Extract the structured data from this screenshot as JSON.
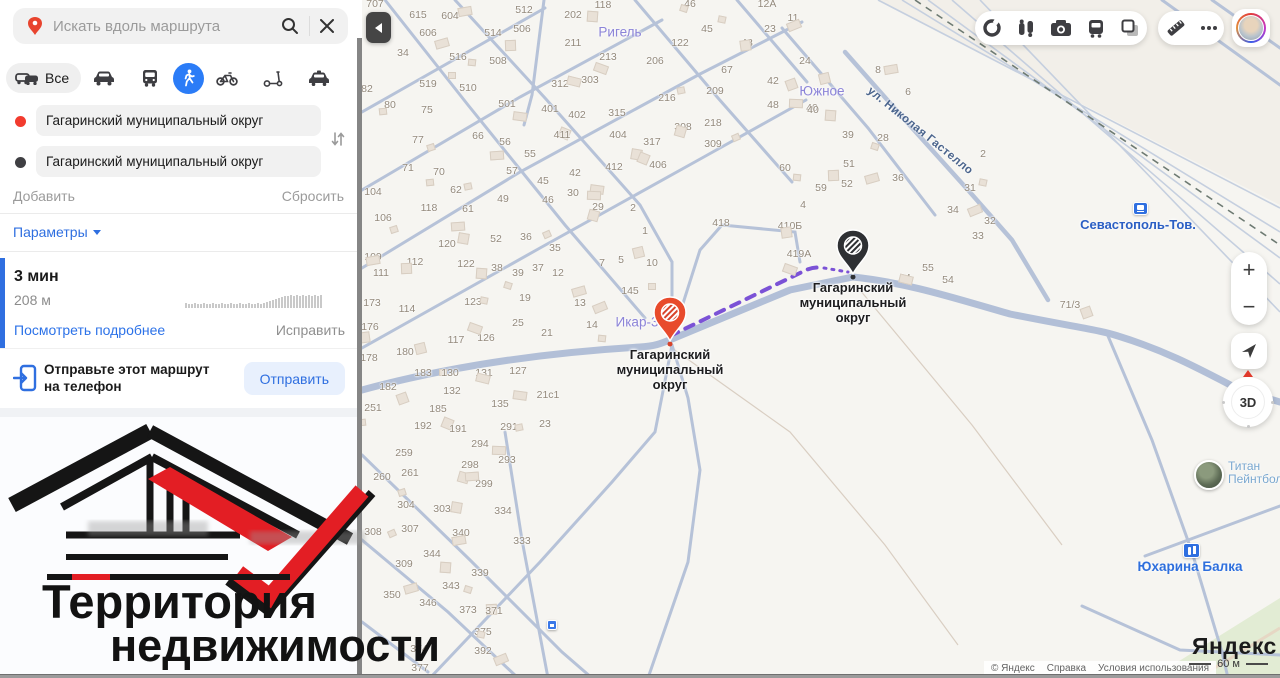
{
  "panel": {
    "search": {
      "placeholder": "Искать вдоль маршрута"
    },
    "modes": {
      "all_label": "Все"
    },
    "route_points": [
      {
        "value": "Гагаринский муниципальный округ"
      },
      {
        "value": "Гагаринский муниципальный округ"
      }
    ],
    "add_label": "Добавить",
    "reset_label": "Сбросить",
    "params_label": "Параметры",
    "summary": {
      "duration": "3 мин",
      "distance": "208 м",
      "details_label": "Посмотреть подробнее",
      "fix_label": "Исправить"
    },
    "send": {
      "line1": "Отправьте этот маршрут",
      "line2": "на телефон",
      "button": "Отправить"
    },
    "logo": {
      "line1": "Территория",
      "line2": "недвижимости"
    }
  },
  "map": {
    "controls": {
      "zoom_in": "+",
      "zoom_out": "−",
      "threed": "3D"
    },
    "markers": [
      {
        "type": "start",
        "x": 670,
        "y": 341,
        "color": "#e84b2c",
        "label_lines": [
          "Гагаринский",
          "муниципальный",
          "округ"
        ]
      },
      {
        "type": "end",
        "x": 853,
        "y": 274,
        "color": "#2e3033",
        "label_lines": [
          "Гагаринский",
          "муниципальный",
          "округ"
        ]
      }
    ],
    "locality_labels": [
      {
        "t": "Ригель",
        "x": 620,
        "y": 32
      },
      {
        "t": "Южное",
        "x": 822,
        "y": 91
      },
      {
        "t": "Икар-3",
        "x": 637,
        "y": 322
      }
    ],
    "street_label": {
      "t": "ул. Николая Гастелло",
      "x": 920,
      "y": 131
    },
    "station": {
      "t": "Севастополь-Тов.",
      "x": 1138,
      "y": 217,
      "icon_x": 1133,
      "icon_y": 202
    },
    "poi": [
      {
        "t1": "Титан",
        "t2": "Пейнтбол",
        "x": 1228,
        "y": 462
      },
      {
        "t1": "Юхарина Балка",
        "t2": "",
        "x": 1190,
        "y": 559
      }
    ],
    "house_numbers": [
      [
        375,
        4,
        "707"
      ],
      [
        418,
        15,
        "615"
      ],
      [
        450,
        16,
        "604"
      ],
      [
        524,
        10,
        "512"
      ],
      [
        573,
        15,
        "202"
      ],
      [
        603,
        5,
        "118"
      ],
      [
        690,
        4,
        "46"
      ],
      [
        767,
        4,
        "12А"
      ],
      [
        428,
        33,
        "606"
      ],
      [
        493,
        33,
        "514"
      ],
      [
        522,
        29,
        "506"
      ],
      [
        573,
        43,
        "211"
      ],
      [
        707,
        29,
        "45"
      ],
      [
        793,
        18,
        "11"
      ],
      [
        770,
        29,
        "23"
      ],
      [
        680,
        43,
        "122"
      ],
      [
        747,
        43,
        "43"
      ],
      [
        403,
        53,
        "34"
      ],
      [
        458,
        57,
        "516"
      ],
      [
        498,
        61,
        "508"
      ],
      [
        608,
        57,
        "213"
      ],
      [
        655,
        61,
        "206"
      ],
      [
        805,
        61,
        "24"
      ],
      [
        727,
        70,
        "67"
      ],
      [
        428,
        84,
        "519"
      ],
      [
        468,
        88,
        "510"
      ],
      [
        560,
        84,
        "312"
      ],
      [
        590,
        80,
        "303"
      ],
      [
        773,
        81,
        "42"
      ],
      [
        367,
        89,
        "82"
      ],
      [
        390,
        105,
        "80"
      ],
      [
        427,
        110,
        "75"
      ],
      [
        507,
        104,
        "501"
      ],
      [
        550,
        109,
        "401"
      ],
      [
        577,
        115,
        "402"
      ],
      [
        617,
        113,
        "315"
      ],
      [
        667,
        98,
        "216"
      ],
      [
        715,
        91,
        "209"
      ],
      [
        773,
        105,
        "48"
      ],
      [
        812,
        108,
        "40"
      ],
      [
        683,
        127,
        "308"
      ],
      [
        713,
        123,
        "218"
      ],
      [
        418,
        140,
        "77"
      ],
      [
        478,
        136,
        "66"
      ],
      [
        505,
        142,
        "56"
      ],
      [
        562,
        135,
        "411"
      ],
      [
        618,
        135,
        "404"
      ],
      [
        652,
        142,
        "317"
      ],
      [
        713,
        144,
        "309"
      ],
      [
        530,
        154,
        "55"
      ],
      [
        878,
        70,
        "8"
      ],
      [
        908,
        92,
        "6"
      ],
      [
        813,
        110,
        "40"
      ],
      [
        848,
        135,
        "39"
      ],
      [
        883,
        138,
        "28"
      ],
      [
        983,
        154,
        "2"
      ],
      [
        849,
        164,
        "51"
      ],
      [
        898,
        178,
        "36"
      ],
      [
        847,
        184,
        "52"
      ],
      [
        821,
        188,
        "59"
      ],
      [
        970,
        188,
        "31"
      ],
      [
        803,
        205,
        "4"
      ],
      [
        953,
        210,
        "34"
      ],
      [
        990,
        221,
        "32"
      ],
      [
        790,
        226,
        "410Б"
      ],
      [
        978,
        236,
        "33"
      ],
      [
        785,
        168,
        "60"
      ],
      [
        721,
        223,
        "418"
      ],
      [
        799,
        254,
        "419А"
      ],
      [
        645,
        231,
        "1"
      ],
      [
        621,
        260,
        "5"
      ],
      [
        652,
        263,
        "10"
      ],
      [
        630,
        291,
        "145"
      ],
      [
        928,
        268,
        "55"
      ],
      [
        905,
        278,
        "64"
      ],
      [
        948,
        280,
        "54"
      ],
      [
        1070,
        305,
        "71/3"
      ],
      [
        408,
        168,
        "71"
      ],
      [
        439,
        172,
        "70"
      ],
      [
        512,
        171,
        "57"
      ],
      [
        575,
        173,
        "42"
      ],
      [
        614,
        167,
        "412"
      ],
      [
        658,
        165,
        "406"
      ],
      [
        373,
        192,
        "104"
      ],
      [
        456,
        190,
        "62"
      ],
      [
        543,
        181,
        "45"
      ],
      [
        573,
        193,
        "30"
      ],
      [
        548,
        200,
        "46"
      ],
      [
        598,
        207,
        "29"
      ],
      [
        633,
        208,
        "2"
      ],
      [
        383,
        218,
        "106"
      ],
      [
        429,
        208,
        "118"
      ],
      [
        468,
        209,
        "61"
      ],
      [
        503,
        199,
        "49"
      ],
      [
        447,
        244,
        "120"
      ],
      [
        496,
        239,
        "52"
      ],
      [
        526,
        237,
        "36"
      ],
      [
        555,
        248,
        "35"
      ],
      [
        373,
        257,
        "109"
      ],
      [
        415,
        262,
        "112"
      ],
      [
        466,
        264,
        "122"
      ],
      [
        497,
        268,
        "38"
      ],
      [
        518,
        273,
        "39"
      ],
      [
        538,
        268,
        "37"
      ],
      [
        558,
        273,
        "12"
      ],
      [
        602,
        263,
        "7"
      ],
      [
        381,
        273,
        "111"
      ],
      [
        372,
        303,
        "173"
      ],
      [
        473,
        302,
        "123"
      ],
      [
        525,
        298,
        "19"
      ],
      [
        580,
        303,
        "13"
      ],
      [
        407,
        309,
        "114"
      ],
      [
        370,
        327,
        "176"
      ],
      [
        518,
        323,
        "25"
      ],
      [
        592,
        325,
        "14"
      ],
      [
        456,
        340,
        "117"
      ],
      [
        486,
        338,
        "126"
      ],
      [
        547,
        333,
        "21"
      ],
      [
        405,
        352,
        "180"
      ],
      [
        369,
        358,
        "178"
      ],
      [
        423,
        373,
        "183"
      ],
      [
        450,
        373,
        "130"
      ],
      [
        484,
        373,
        "131"
      ],
      [
        518,
        371,
        "127"
      ],
      [
        388,
        387,
        "182"
      ],
      [
        452,
        391,
        "132"
      ],
      [
        373,
        408,
        "251"
      ],
      [
        438,
        409,
        "185"
      ],
      [
        500,
        404,
        "135"
      ],
      [
        548,
        395,
        "21с1"
      ],
      [
        423,
        426,
        "192"
      ],
      [
        458,
        429,
        "191"
      ],
      [
        509,
        427,
        "291"
      ],
      [
        545,
        424,
        "23"
      ],
      [
        480,
        444,
        "294"
      ],
      [
        404,
        453,
        "259"
      ],
      [
        470,
        465,
        "298"
      ],
      [
        507,
        460,
        "293"
      ],
      [
        382,
        477,
        "260"
      ],
      [
        410,
        473,
        "261"
      ],
      [
        484,
        484,
        "299"
      ],
      [
        406,
        505,
        "304"
      ],
      [
        442,
        509,
        "303"
      ],
      [
        503,
        511,
        "334"
      ],
      [
        373,
        532,
        "308"
      ],
      [
        410,
        529,
        "307"
      ],
      [
        461,
        533,
        "340"
      ],
      [
        522,
        541,
        "333"
      ],
      [
        432,
        554,
        "344"
      ],
      [
        404,
        564,
        "309"
      ],
      [
        480,
        573,
        "339"
      ],
      [
        451,
        586,
        "343"
      ],
      [
        392,
        595,
        "350"
      ],
      [
        428,
        603,
        "346"
      ],
      [
        468,
        610,
        "373"
      ],
      [
        494,
        611,
        "371"
      ],
      [
        483,
        632,
        "375"
      ],
      [
        419,
        649,
        "374"
      ],
      [
        483,
        651,
        "392"
      ],
      [
        420,
        668,
        "377"
      ]
    ],
    "attribution": {
      "copyright": "© Яндекс",
      "help": "Справка",
      "terms": "Условия использования",
      "brand": "Яндекс",
      "scale": "60 м"
    }
  },
  "icons": {
    "toolbar": [
      "traffic-ring",
      "panoramas",
      "photos",
      "transport",
      "layers",
      "ruler",
      "more",
      "profile"
    ],
    "modes": [
      "all-cars",
      "car",
      "bus",
      "pedestrian",
      "bike",
      "scooter",
      "taxi"
    ]
  },
  "colors": {
    "accent_blue": "#2f6fe0",
    "route_purple": "#7b52d6",
    "pin_red": "#e84b2c",
    "pin_dark": "#2e3033",
    "logo_red": "#e31e24"
  }
}
